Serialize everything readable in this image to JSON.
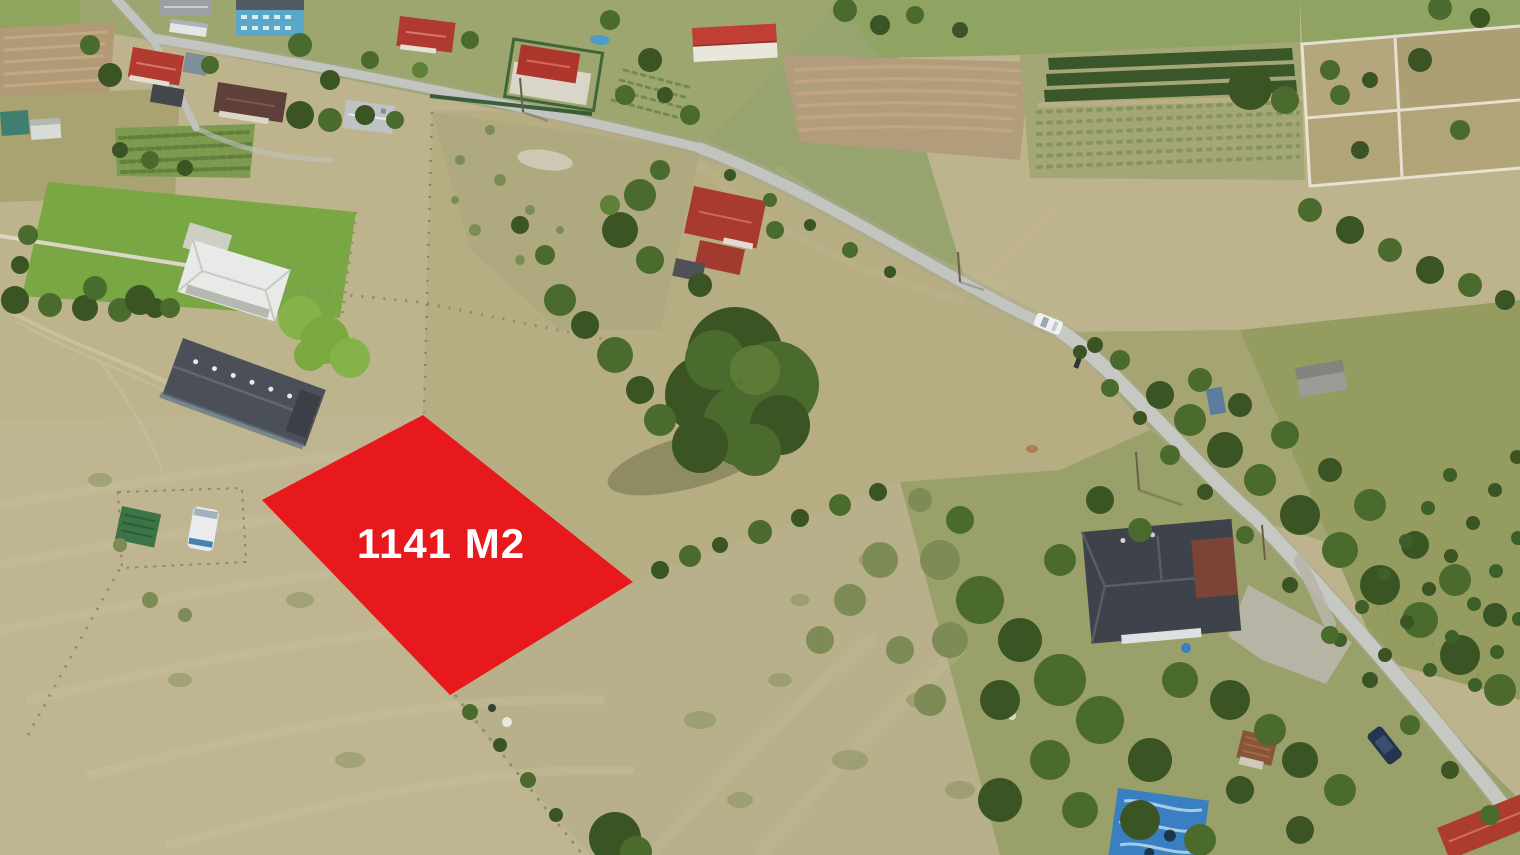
{
  "scene": {
    "kind": "drone-aerial-photo"
  },
  "parcel": {
    "label": "1141 M2",
    "fill_color": "#e8191c",
    "label_color": "#ffffff"
  },
  "palette": {
    "dry_grass": "#bdb48d",
    "green_meadow": "#78a743",
    "road_gray": "#c2c5bf",
    "tree_dark_green": "#3a5424",
    "red_roof": "#b23a31",
    "dark_roof": "#43474c",
    "blue_house": "#5aa7c9",
    "plowed_soil": "#b29a77",
    "overlay_red": "#e8191c"
  }
}
